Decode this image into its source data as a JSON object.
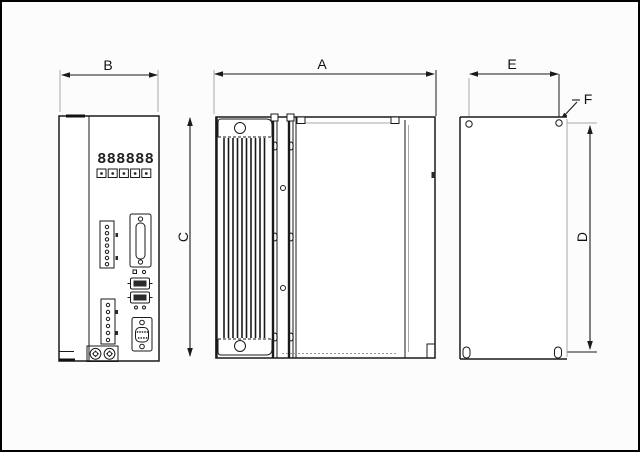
{
  "labels": {
    "dim_side_width": "A",
    "dim_front_width": "B",
    "dim_body_height": "C",
    "dim_hole_pitch_vertical": "D",
    "dim_hole_pitch_horizontal": "E",
    "hole_callout": "F"
  },
  "front_panel": {
    "display": "888888"
  },
  "colors": {
    "line": "#1a1a1a",
    "extension_line": "#a9a9a9",
    "background": "#fbfbfb",
    "view_fill": "#ffffff",
    "frame": "#000000"
  }
}
